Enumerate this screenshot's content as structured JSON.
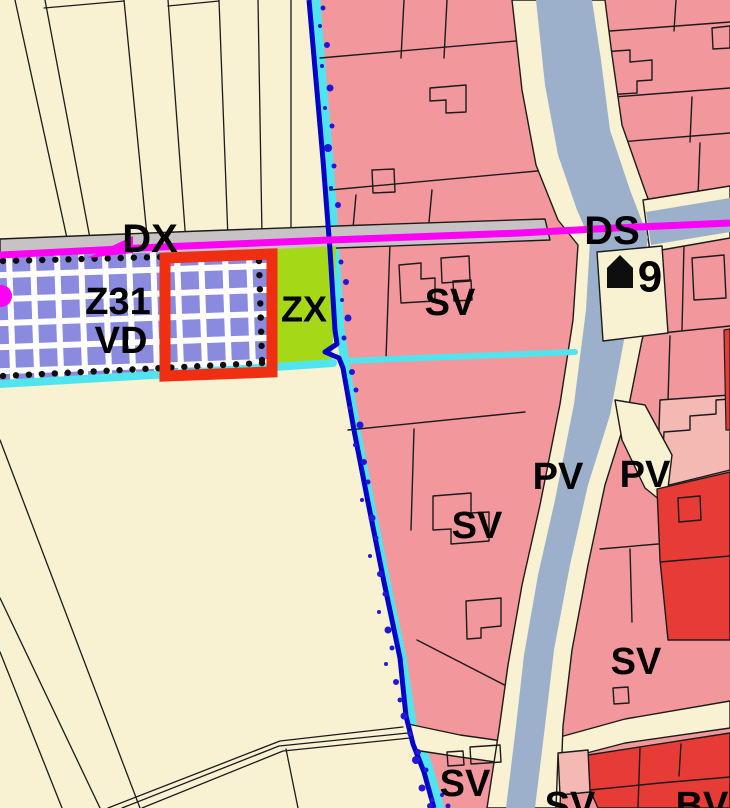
{
  "canvas": {
    "width": 730,
    "height": 808
  },
  "colors": {
    "cream": "#F8F2D3",
    "pink": "#F2989C",
    "pink_light": "#F5B9B4",
    "red": "#E73C36",
    "canal": "#9DB0CB",
    "road_gray": "#C7C3C4",
    "magenta": "#FF00F6",
    "cyan": "#50E5EE",
    "blue": "#0004C8",
    "dot_blue": "#2217D8",
    "lavender": "#8A8ADF",
    "lime": "#A5D816",
    "red_box": "#EF2E12",
    "line_black": "#1B1B1B",
    "white": "#FFFFFF",
    "icon_black": "#0E0E0E"
  },
  "shapes": [
    {
      "name": "background",
      "type": "rect",
      "x": 0,
      "y": 0,
      "w": 730,
      "h": 808,
      "fill": "cream"
    },
    {
      "name": "field-line",
      "type": "line",
      "pts": "15,0 70,252",
      "stroke": "line_black",
      "sw": 1.3
    },
    {
      "name": "field-line",
      "type": "line",
      "pts": "45,0 92,249",
      "stroke": "line_black",
      "sw": 1.3
    },
    {
      "name": "field-line",
      "type": "line",
      "pts": "124,0 148,246",
      "stroke": "line_black",
      "sw": 1.3
    },
    {
      "name": "field-line",
      "type": "line",
      "pts": "168,0 186,243",
      "stroke": "line_black",
      "sw": 1.3
    },
    {
      "name": "field-line",
      "type": "line",
      "pts": "219,0 228,239",
      "stroke": "line_black",
      "sw": 1.3
    },
    {
      "name": "field-line",
      "type": "line",
      "pts": "258,0 262,236",
      "stroke": "line_black",
      "sw": 1.3
    },
    {
      "name": "field-line",
      "type": "line",
      "pts": "291,0 291,233",
      "stroke": "line_black",
      "sw": 1.3
    },
    {
      "name": "field-line-connector",
      "type": "line",
      "pts": "44,8 124,1",
      "stroke": "line_black",
      "sw": 1.3
    },
    {
      "name": "field-line-connector",
      "type": "line",
      "pts": "168,6 219,1",
      "stroke": "line_black",
      "sw": 1.3
    },
    {
      "name": "field-diagonal",
      "type": "line",
      "pts": "0,440 140,808",
      "stroke": "line_black",
      "sw": 1.3
    },
    {
      "name": "field-diagonal",
      "type": "line",
      "pts": "0,598 100,808",
      "stroke": "line_black",
      "sw": 1.3
    },
    {
      "name": "field-diagonal",
      "type": "line",
      "pts": "0,652 62,808",
      "stroke": "line_black",
      "sw": 1.3
    },
    {
      "name": "path-road-line",
      "type": "polyline",
      "pts": "108,808 280,741 403,727",
      "stroke": "line_black",
      "sw": 1.3
    },
    {
      "name": "path-road-line",
      "type": "polyline",
      "pts": "122,808 279,746 408,733",
      "stroke": "line_black",
      "sw": 1.3
    },
    {
      "name": "path-road-line",
      "type": "polyline",
      "pts": "142,808 283,751 410,738",
      "stroke": "line_black",
      "sw": 1.3
    },
    {
      "name": "path-road-branch",
      "type": "line",
      "pts": "286,749 298,808",
      "stroke": "line_black",
      "sw": 1.3
    },
    {
      "name": "zone-residential-pink",
      "type": "polygon",
      "pts": "312,0 730,0 730,808 436,808 424,762 408,722 398,655 382,580 366,500 352,428 341,360 336,330 331,250 325,160 318,80",
      "fill": "pink"
    },
    {
      "name": "boundary-cyan-band",
      "type": "polyline",
      "pts": "316,0 322,80 329,160 335,250 340,330 345,362 356,430 370,502 386,582 402,658 412,724 428,766 440,808",
      "stroke": "cyan",
      "sw": 9
    },
    {
      "name": "parcel-line",
      "type": "line",
      "pts": "320,58 527,40",
      "stroke": "line_black",
      "sw": 1.4
    },
    {
      "name": "parcel-line",
      "type": "line",
      "pts": "330,190 548,170",
      "stroke": "line_black",
      "sw": 1.4
    },
    {
      "name": "parcel-line",
      "type": "line",
      "pts": "404,0 401,58",
      "stroke": "line_black",
      "sw": 1.4
    },
    {
      "name": "parcel-line",
      "type": "line",
      "pts": "447,0 444,58",
      "stroke": "line_black",
      "sw": 1.4
    },
    {
      "name": "building-outline",
      "type": "polygon",
      "pts": "430,88 466,85 466,112 446,113 446,100 430,101",
      "fill": "none",
      "stroke": "line_black",
      "sw": 1.4
    },
    {
      "name": "building-outline",
      "type": "polygon",
      "pts": "372,170 394,169 395,192 373,193",
      "fill": "none",
      "stroke": "line_black",
      "sw": 1.4
    },
    {
      "name": "parcel-line",
      "type": "line",
      "pts": "356,195 353,228",
      "stroke": "line_black",
      "sw": 1.4
    },
    {
      "name": "parcel-line",
      "type": "line",
      "pts": "432,190 429,222",
      "stroke": "line_black",
      "sw": 1.4
    },
    {
      "name": "parcel-line",
      "type": "line",
      "pts": "610,31 730,22",
      "stroke": "line_black",
      "sw": 1.4
    },
    {
      "name": "parcel-line",
      "type": "line",
      "pts": "614,97 730,88",
      "stroke": "line_black",
      "sw": 1.4
    },
    {
      "name": "parcel-line",
      "type": "line",
      "pts": "676,0 674,31",
      "stroke": "line_black",
      "sw": 1.4
    },
    {
      "name": "parcel-line",
      "type": "line",
      "pts": "692,97 690,142",
      "stroke": "line_black",
      "sw": 1.4
    },
    {
      "name": "building-outline",
      "type": "polygon",
      "pts": "602,52 630,50 630,62 652,60 652,80 637,81 637,93 604,95",
      "fill": "none",
      "stroke": "line_black",
      "sw": 1.4
    },
    {
      "name": "parcel-line",
      "type": "line",
      "pts": "607,143 730,133",
      "stroke": "line_black",
      "sw": 1.4
    },
    {
      "name": "parcel-line",
      "type": "line",
      "pts": "700,143 698,196",
      "stroke": "line_black",
      "sw": 1.4
    },
    {
      "name": "building-outline",
      "type": "polygon",
      "pts": "712,28 730,26 730,48 713,49",
      "fill": "none",
      "stroke": "line_black",
      "sw": 1.4
    },
    {
      "name": "parcel-line",
      "type": "line",
      "pts": "684,244 682,330",
      "stroke": "line_black",
      "sw": 1.4
    },
    {
      "name": "building-outline",
      "type": "polygon",
      "pts": "692,258 724,255 726,298 694,300",
      "fill": "none",
      "stroke": "line_black",
      "sw": 1.4
    },
    {
      "name": "parcel-line",
      "type": "line",
      "pts": "662,333 730,326",
      "stroke": "line_black",
      "sw": 1.4
    },
    {
      "name": "parcel-line",
      "type": "line",
      "pts": "670,336 668,400",
      "stroke": "line_black",
      "sw": 1.4
    },
    {
      "name": "zone-pink-light",
      "type": "polygon",
      "pts": "660,400 730,395 730,470 657,488",
      "fill": "pink_light",
      "stroke": "line_black",
      "sw": 1.4
    },
    {
      "name": "parcel-stairs",
      "type": "polyline",
      "pts": "664,432 690,430 690,416 716,414 716,400 730,399",
      "stroke": "line_black",
      "sw": 1.4
    },
    {
      "name": "parcel-line",
      "type": "line",
      "pts": "664,432 662,470",
      "stroke": "line_black",
      "sw": 1.4
    },
    {
      "name": "parcel-line",
      "type": "line",
      "pts": "390,243 386,358",
      "stroke": "line_black",
      "sw": 1.4
    },
    {
      "name": "building-outline",
      "type": "polygon",
      "pts": "399,265 421,263 421,279 435,278 435,301 401,303",
      "fill": "none",
      "stroke": "line_black",
      "sw": 1.4
    },
    {
      "name": "building-outline",
      "type": "polygon",
      "pts": "441,258 469,256 470,281 442,283",
      "fill": "none",
      "stroke": "line_black",
      "sw": 1.4
    },
    {
      "name": "building-outline",
      "type": "polygon",
      "pts": "453,281 471,280 472,300 454,301",
      "fill": "none",
      "stroke": "line_black",
      "sw": 1.4
    },
    {
      "name": "parcel-line",
      "type": "line",
      "pts": "348,430 525,412",
      "stroke": "line_black",
      "sw": 1.4
    },
    {
      "name": "parcel-line",
      "type": "line",
      "pts": "414,429 411,530",
      "stroke": "line_black",
      "sw": 1.4
    },
    {
      "name": "building-outline",
      "type": "polygon",
      "pts": "433,496 471,493 471,513 489,512 489,541 451,544 451,529 433,530",
      "fill": "none",
      "stroke": "line_black",
      "sw": 1.4
    },
    {
      "name": "building-outline",
      "type": "polygon",
      "pts": "466,601 501,598 501,626 481,628 481,638 467,639",
      "fill": "none",
      "stroke": "line_black",
      "sw": 1.4
    },
    {
      "name": "parcel-line",
      "type": "line",
      "pts": "417,640 522,694",
      "stroke": "line_black",
      "sw": 1.4
    },
    {
      "name": "parcel-line",
      "type": "line",
      "pts": "600,549 658,544",
      "stroke": "line_black",
      "sw": 1.4
    },
    {
      "name": "parcel-line",
      "type": "line",
      "pts": "630,549 632,622",
      "stroke": "line_black",
      "sw": 1.4
    },
    {
      "name": "building-outline",
      "type": "polygon",
      "pts": "613,688 628,687 629,703 614,704",
      "fill": "none",
      "stroke": "line_black",
      "sw": 1.4
    },
    {
      "name": "road-dx",
      "type": "polygon",
      "pts": "0,239 200,231 365,225 545,219 550,240 365,247 200,253 0,261",
      "fill": "road_gray",
      "stroke": "line_black",
      "sw": 1.4
    },
    {
      "name": "road-south",
      "type": "polygon",
      "pts": "408,724 460,735 510,742 560,737 625,719 730,701 730,728 625,743 560,760 510,764 460,757 414,750",
      "fill": "cream",
      "stroke": "line_black",
      "sw": 1.4
    },
    {
      "name": "canal-road",
      "type": "polygon",
      "pts": "512,0 522,90 536,165 558,220 578,245 573,320 560,404 540,505 522,585 508,665 499,730 487,808 560,808 563,726 572,650 588,565 605,485 627,415 642,340 658,285 663,240 643,185 622,125 612,55 605,0",
      "fill": "cream",
      "stroke": "line_black",
      "sw": 1.4
    },
    {
      "name": "ds-road",
      "type": "polygon",
      "pts": "643,200 730,186 730,238 650,252",
      "fill": "cream",
      "stroke": "line_black",
      "sw": 1.4
    },
    {
      "name": "canal-water",
      "type": "polygon",
      "pts": "536,0 545,85 558,155 577,210 590,240 586,310 574,404 555,500 538,575 524,655 516,726 506,808 535,808 545,726 554,650 570,565 588,485 610,415 625,335 643,272 648,237 630,190 610,130 601,60 592,0",
      "fill": "canal"
    },
    {
      "name": "ds-water",
      "type": "polygon",
      "pts": "646,212 730,198 730,232 651,245",
      "fill": "canal"
    },
    {
      "name": "road-wedge",
      "type": "polygon",
      "pts": "615,400 645,405 672,455 666,505 645,488 622,440",
      "fill": "cream",
      "stroke": "line_black",
      "sw": 1.4
    },
    {
      "name": "parcel-house",
      "type": "polygon",
      "pts": "597,252 662,246 668,333 603,341",
      "fill": "cream",
      "stroke": "line_black",
      "sw": 1.4
    },
    {
      "name": "zone-red-mid",
      "type": "polygon",
      "pts": "657,489 730,472 730,640 668,640 660,560",
      "fill": "red",
      "stroke": "line_black",
      "sw": 1.4
    },
    {
      "name": "building-outline",
      "type": "polygon",
      "pts": "678,498 700,496 701,520 679,522",
      "fill": "none",
      "stroke": "line_black",
      "sw": 1.4
    },
    {
      "name": "parcel-line",
      "type": "line",
      "pts": "660,562 730,556",
      "stroke": "line_black",
      "sw": 1.4
    },
    {
      "name": "zone-red-edge",
      "type": "polygon",
      "pts": "724,330 730,329 730,430 726,430",
      "fill": "red",
      "stroke": "line_black",
      "sw": 1.2
    },
    {
      "name": "zone-red-south",
      "type": "polygon",
      "pts": "588,755 730,733 730,808 598,808 590,790",
      "fill": "red",
      "stroke": "line_black",
      "sw": 1.4
    },
    {
      "name": "parcel-line",
      "type": "line",
      "pts": "640,748 638,808",
      "stroke": "line_black",
      "sw": 1.4
    },
    {
      "name": "parcel-line",
      "type": "line",
      "pts": "681,744 679,776",
      "stroke": "line_black",
      "sw": 1.4
    },
    {
      "name": "parcel-line",
      "type": "polyline",
      "pts": "590,790 660,783 730,777",
      "stroke": "line_black",
      "sw": 1.4
    },
    {
      "name": "zone-pink-light-small",
      "type": "polygon",
      "pts": "558,753 588,750 590,792 560,795",
      "fill": "pink_light",
      "stroke": "line_black",
      "sw": 1.4
    },
    {
      "name": "parcel-line",
      "type": "line",
      "pts": "558,755 556,808",
      "stroke": "line_black",
      "sw": 1.4
    },
    {
      "name": "building-outline",
      "type": "polygon",
      "pts": "447,752 463,751 464,765 448,766",
      "fill": "none",
      "stroke": "line_black",
      "sw": 1.4
    },
    {
      "name": "building-outline",
      "type": "polygon",
      "pts": "470,747 500,745 501,762 471,764",
      "fill": "none",
      "stroke": "line_black",
      "sw": 1.4
    },
    {
      "name": "zone-z31-base",
      "type": "polygon",
      "pts": "0,256 277,250 277,370 0,382",
      "fill": "white"
    },
    {
      "name": "zone-z31-grid",
      "type": "polygon",
      "pts": "0,256 277,250 277,370 0,382",
      "fill": "@pattern"
    },
    {
      "name": "zone-zx",
      "type": "polygon",
      "pts": "277,249 336,246 332,366 277,369",
      "fill": "lime"
    },
    {
      "name": "cyan-strip-west",
      "type": "polyline",
      "pts": "0,384 170,374 333,363",
      "stroke": "cyan",
      "sw": 8
    },
    {
      "name": "cyan-strip-east",
      "type": "polyline",
      "pts": "343,361 575,352",
      "stroke": "cyan",
      "sw": 6
    }
  ],
  "strip_dots": {
    "r": 3.2,
    "spacing": 12.5,
    "fill": "icon_black",
    "edges": [
      {
        "from": [
          3,
          261
        ],
        "to": [
          160,
          257
        ]
      },
      {
        "from": [
          259,
          261
        ],
        "to": [
          262,
          360
        ]
      },
      {
        "from": [
          3,
          376
        ],
        "to": [
          262,
          363
        ]
      }
    ]
  },
  "selection_box": {
    "name": "selection-red-box",
    "pts": "165,258 272,254 272,372 165,376",
    "stroke": "red_box",
    "sw": 11
  },
  "boundary_line": {
    "name": "boundary-blue-line",
    "pts": "309,0 316,80 323,160 330,250 335,330 337,344 325,352 339,358 343,368 354,430 368,502 384,582 400,658 406,716 413,744 424,772 434,808",
    "stroke": "blue",
    "sw": 5
  },
  "boundary_dots": {
    "fill": "dot_blue",
    "points": [
      [
        323,
        8,
        2.5
      ],
      [
        320,
        26,
        2
      ],
      [
        327,
        45,
        3
      ],
      [
        322,
        66,
        2
      ],
      [
        330,
        88,
        3.5
      ],
      [
        325,
        108,
        2
      ],
      [
        332,
        126,
        2.5
      ],
      [
        328,
        148,
        4
      ],
      [
        334,
        166,
        2.5
      ],
      [
        331,
        188,
        2
      ],
      [
        338,
        205,
        3
      ],
      [
        341,
        262,
        2.5
      ],
      [
        346,
        282,
        3
      ],
      [
        342,
        300,
        2
      ],
      [
        348,
        318,
        3.5
      ],
      [
        344,
        338,
        2.5
      ],
      [
        352,
        372,
        3
      ],
      [
        356,
        390,
        2.5
      ],
      [
        350,
        408,
        2
      ],
      [
        360,
        425,
        3.5
      ],
      [
        355,
        445,
        2
      ],
      [
        364,
        462,
        3
      ],
      [
        368,
        482,
        2.5
      ],
      [
        362,
        500,
        2
      ],
      [
        372,
        518,
        3.5
      ],
      [
        376,
        538,
        2.5
      ],
      [
        370,
        556,
        2
      ],
      [
        380,
        574,
        3
      ],
      [
        385,
        594,
        2.5
      ],
      [
        379,
        612,
        2
      ],
      [
        388,
        630,
        3.5
      ],
      [
        392,
        648,
        2.5
      ],
      [
        386,
        664,
        2
      ],
      [
        396,
        682,
        3
      ],
      [
        400,
        700,
        2.5
      ],
      [
        404,
        716,
        3.5
      ],
      [
        416,
        760,
        4
      ],
      [
        410,
        734,
        2.5
      ],
      [
        418,
        752,
        3
      ],
      [
        426,
        770,
        2.5
      ],
      [
        422,
        788,
        3.5
      ],
      [
        432,
        800,
        2.5
      ],
      [
        430,
        806,
        3
      ],
      [
        442,
        795,
        2
      ],
      [
        448,
        806,
        2.5
      ]
    ]
  },
  "route": {
    "name": "route-ds-line",
    "line_pts": "0,255 160,247 330,240 520,233 615,228 730,223",
    "width": 7,
    "color": "magenta",
    "arrow_pts": "87,258 133,236 133,253",
    "node": {
      "cx": 1,
      "cy": 296,
      "r": 11
    }
  },
  "house_marker": {
    "name": "house-icon",
    "pts": "607,268 620,255 633,268 633,288 607,288",
    "fill": "icon_black"
  },
  "labels": [
    {
      "id": "label-dx",
      "text": "DX",
      "x": 150,
      "y": 239,
      "size": 40
    },
    {
      "id": "label-ds",
      "text": "DS",
      "x": 612,
      "y": 231,
      "size": 40
    },
    {
      "id": "label-z31",
      "text": "Z31",
      "x": 118,
      "y": 302,
      "size": 38
    },
    {
      "id": "label-vd",
      "text": "VD",
      "x": 121,
      "y": 341,
      "size": 38
    },
    {
      "id": "label-zx",
      "text": "ZX",
      "x": 304,
      "y": 309,
      "size": 36
    },
    {
      "id": "label-sv-1",
      "text": "SV",
      "x": 450,
      "y": 303,
      "size": 38
    },
    {
      "id": "label-9",
      "text": "9",
      "x": 650,
      "y": 277,
      "size": 44
    },
    {
      "id": "label-pv-1",
      "text": "PV",
      "x": 558,
      "y": 477,
      "size": 38
    },
    {
      "id": "label-pv-2",
      "text": "PV",
      "x": 645,
      "y": 475,
      "size": 38
    },
    {
      "id": "label-sv-2",
      "text": "SV",
      "x": 477,
      "y": 526,
      "size": 38
    },
    {
      "id": "label-sv-3",
      "text": "SV",
      "x": 636,
      "y": 662,
      "size": 38
    },
    {
      "id": "label-sv-4",
      "text": "SV",
      "x": 465,
      "y": 784,
      "size": 38
    },
    {
      "id": "label-sv-5",
      "text": "SV",
      "x": 570,
      "y": 806,
      "size": 38
    },
    {
      "id": "label-bv",
      "text": "BV",
      "x": 702,
      "y": 806,
      "size": 38
    }
  ]
}
